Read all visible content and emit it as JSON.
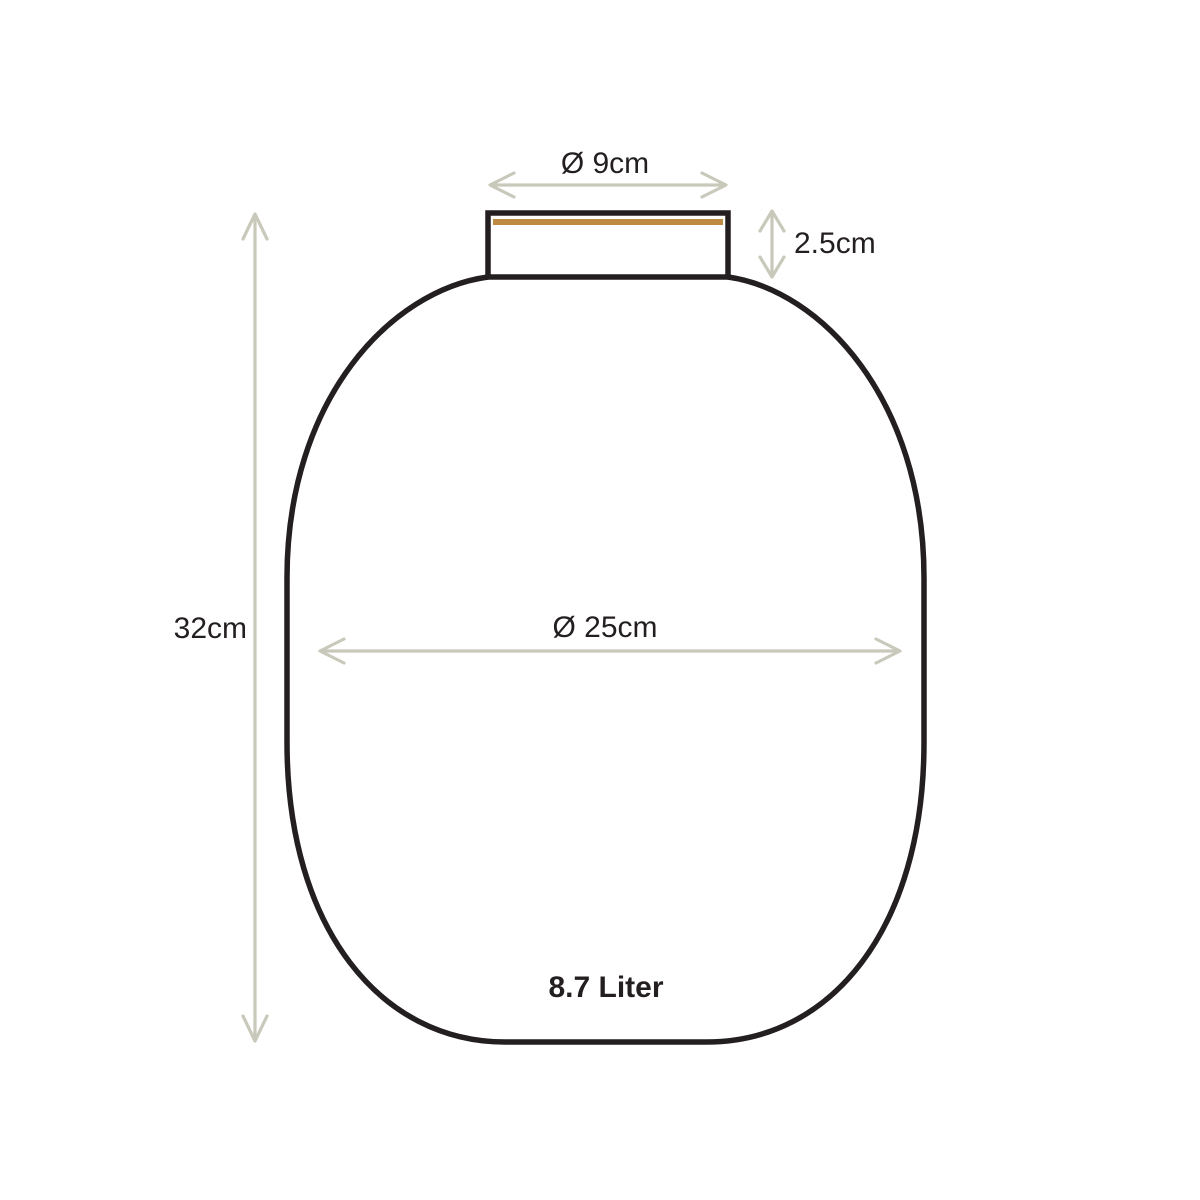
{
  "diagram": {
    "type": "product-dimension-drawing",
    "subject": "vase",
    "labels": {
      "opening_diameter": "Ø 9cm",
      "neck_height": "2.5cm",
      "total_height": "32cm",
      "body_diameter": "Ø 25cm",
      "volume": "8.7 Liter"
    },
    "colors": {
      "outline": "#231f20",
      "dimension": "#c9c9bb",
      "rim_gold": "#bd8c42",
      "background": "#ffffff"
    }
  }
}
